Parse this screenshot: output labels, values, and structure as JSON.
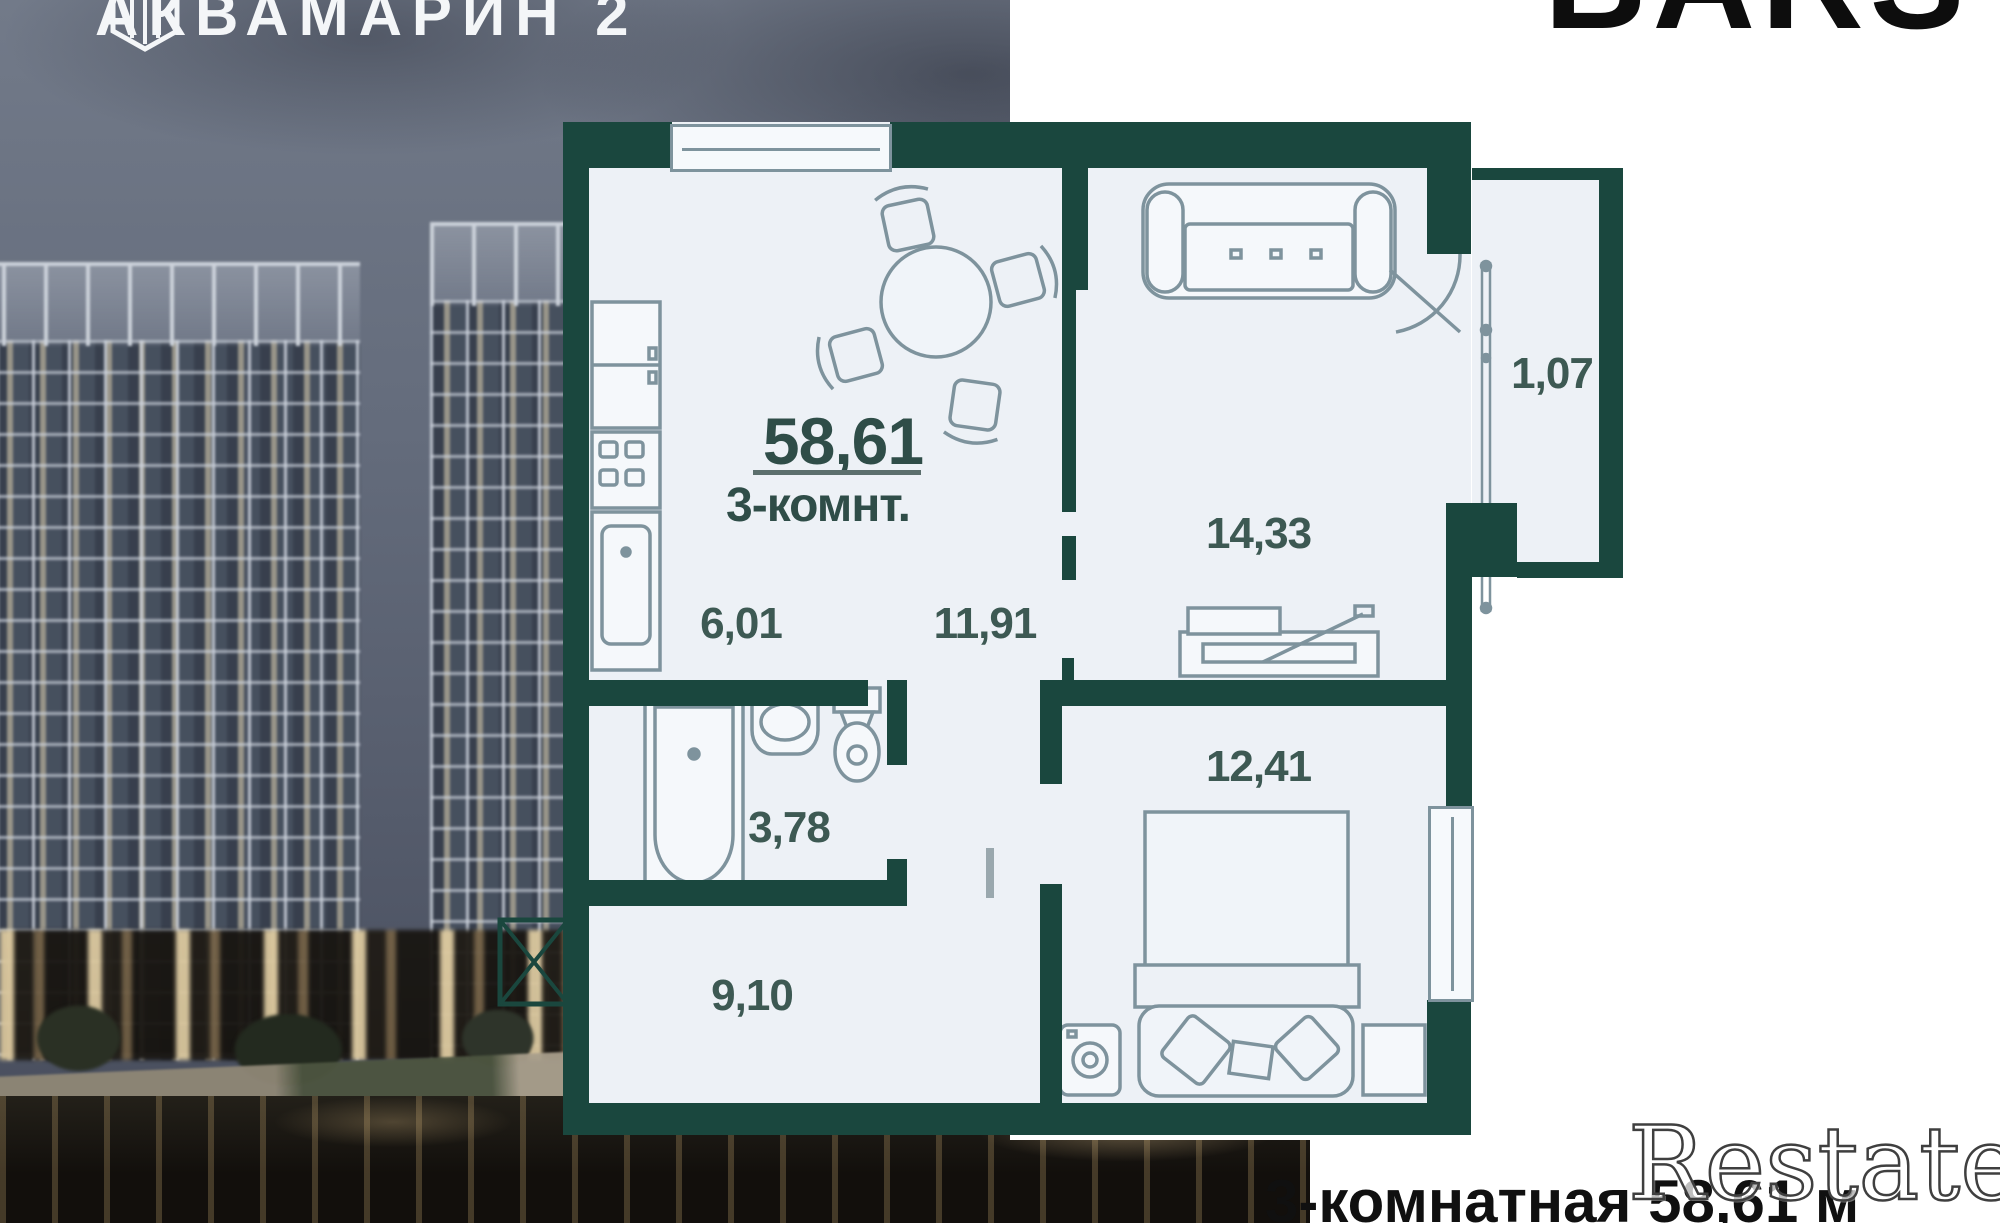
{
  "branding": {
    "complex_name": "АКВАМАРИН 2",
    "developer_name": "BARS",
    "watermark": "Restate",
    "logo_icon": "hexagon-gem-icon"
  },
  "floorplan": {
    "total_area": "58,61",
    "layout_label": "3-комнт.",
    "rooms": [
      {
        "name": "kitchen",
        "area": "6,01"
      },
      {
        "name": "hallway",
        "area": "11,91"
      },
      {
        "name": "living-room",
        "area": "14,33"
      },
      {
        "name": "balcony",
        "area": "1,07"
      },
      {
        "name": "bathroom",
        "area": "3,78"
      },
      {
        "name": "bedroom",
        "area": "12,41"
      },
      {
        "name": "corridor",
        "area": "9,10"
      }
    ]
  },
  "caption": {
    "title": "3-комнатная 58,61 м"
  },
  "colors": {
    "wall": "#1A473E",
    "floor": "#EDF1F6",
    "furniture_stroke": "#7E939D",
    "room_label": "#3D5953",
    "caption_text": "#101010",
    "logo_text": "#F4F6F8",
    "developer_text": "#0D0D0D"
  }
}
